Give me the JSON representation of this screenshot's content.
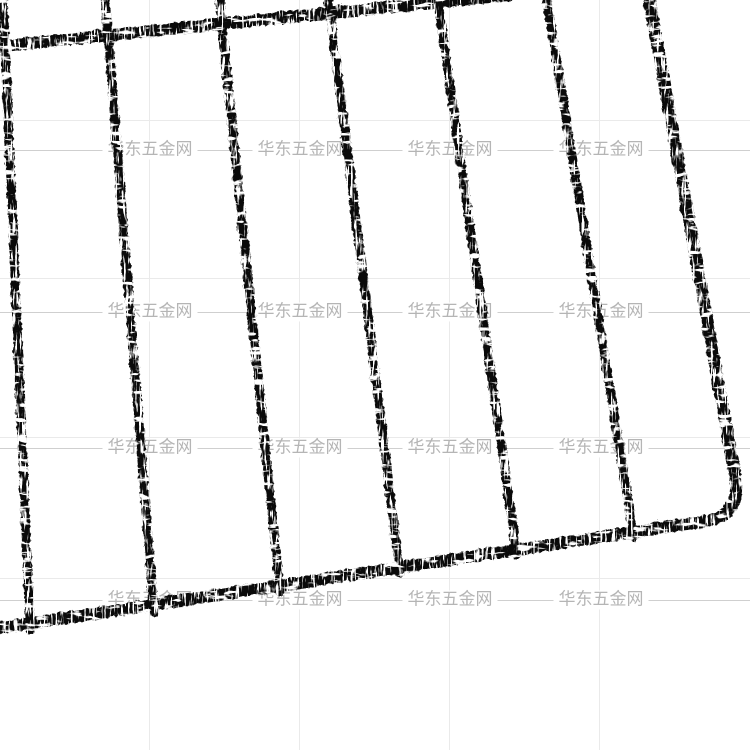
{
  "scene": {
    "description": "Corner of a black chrome-plated wire grid rack (oven / grill shelf) photographed at a slight angle on a plain white background",
    "background_color": "#ffffff",
    "rack_color": "#0a0a0a",
    "rack_highlight_color": "#ffffff"
  },
  "background_grid": {
    "line_color": "#eaeaea",
    "vertical_lines_x": [
      149,
      299,
      449,
      599
    ],
    "horizontal_lines_y": [
      120,
      278,
      437,
      578
    ]
  },
  "watermark": {
    "text": "华东五金网",
    "text_color": "#b5b5b5",
    "line_color": "#cfcfcf",
    "font_size_px": 17,
    "rows_y": [
      150,
      312,
      448,
      600
    ],
    "columns_x": [
      150,
      300,
      450,
      601
    ]
  },
  "rack": {
    "vertical_wire_count": 6,
    "frame_parts": [
      "top-frame-bar",
      "right-frame-bar",
      "rounded-bottom-right-corner",
      "bottom-frame-bar"
    ]
  }
}
